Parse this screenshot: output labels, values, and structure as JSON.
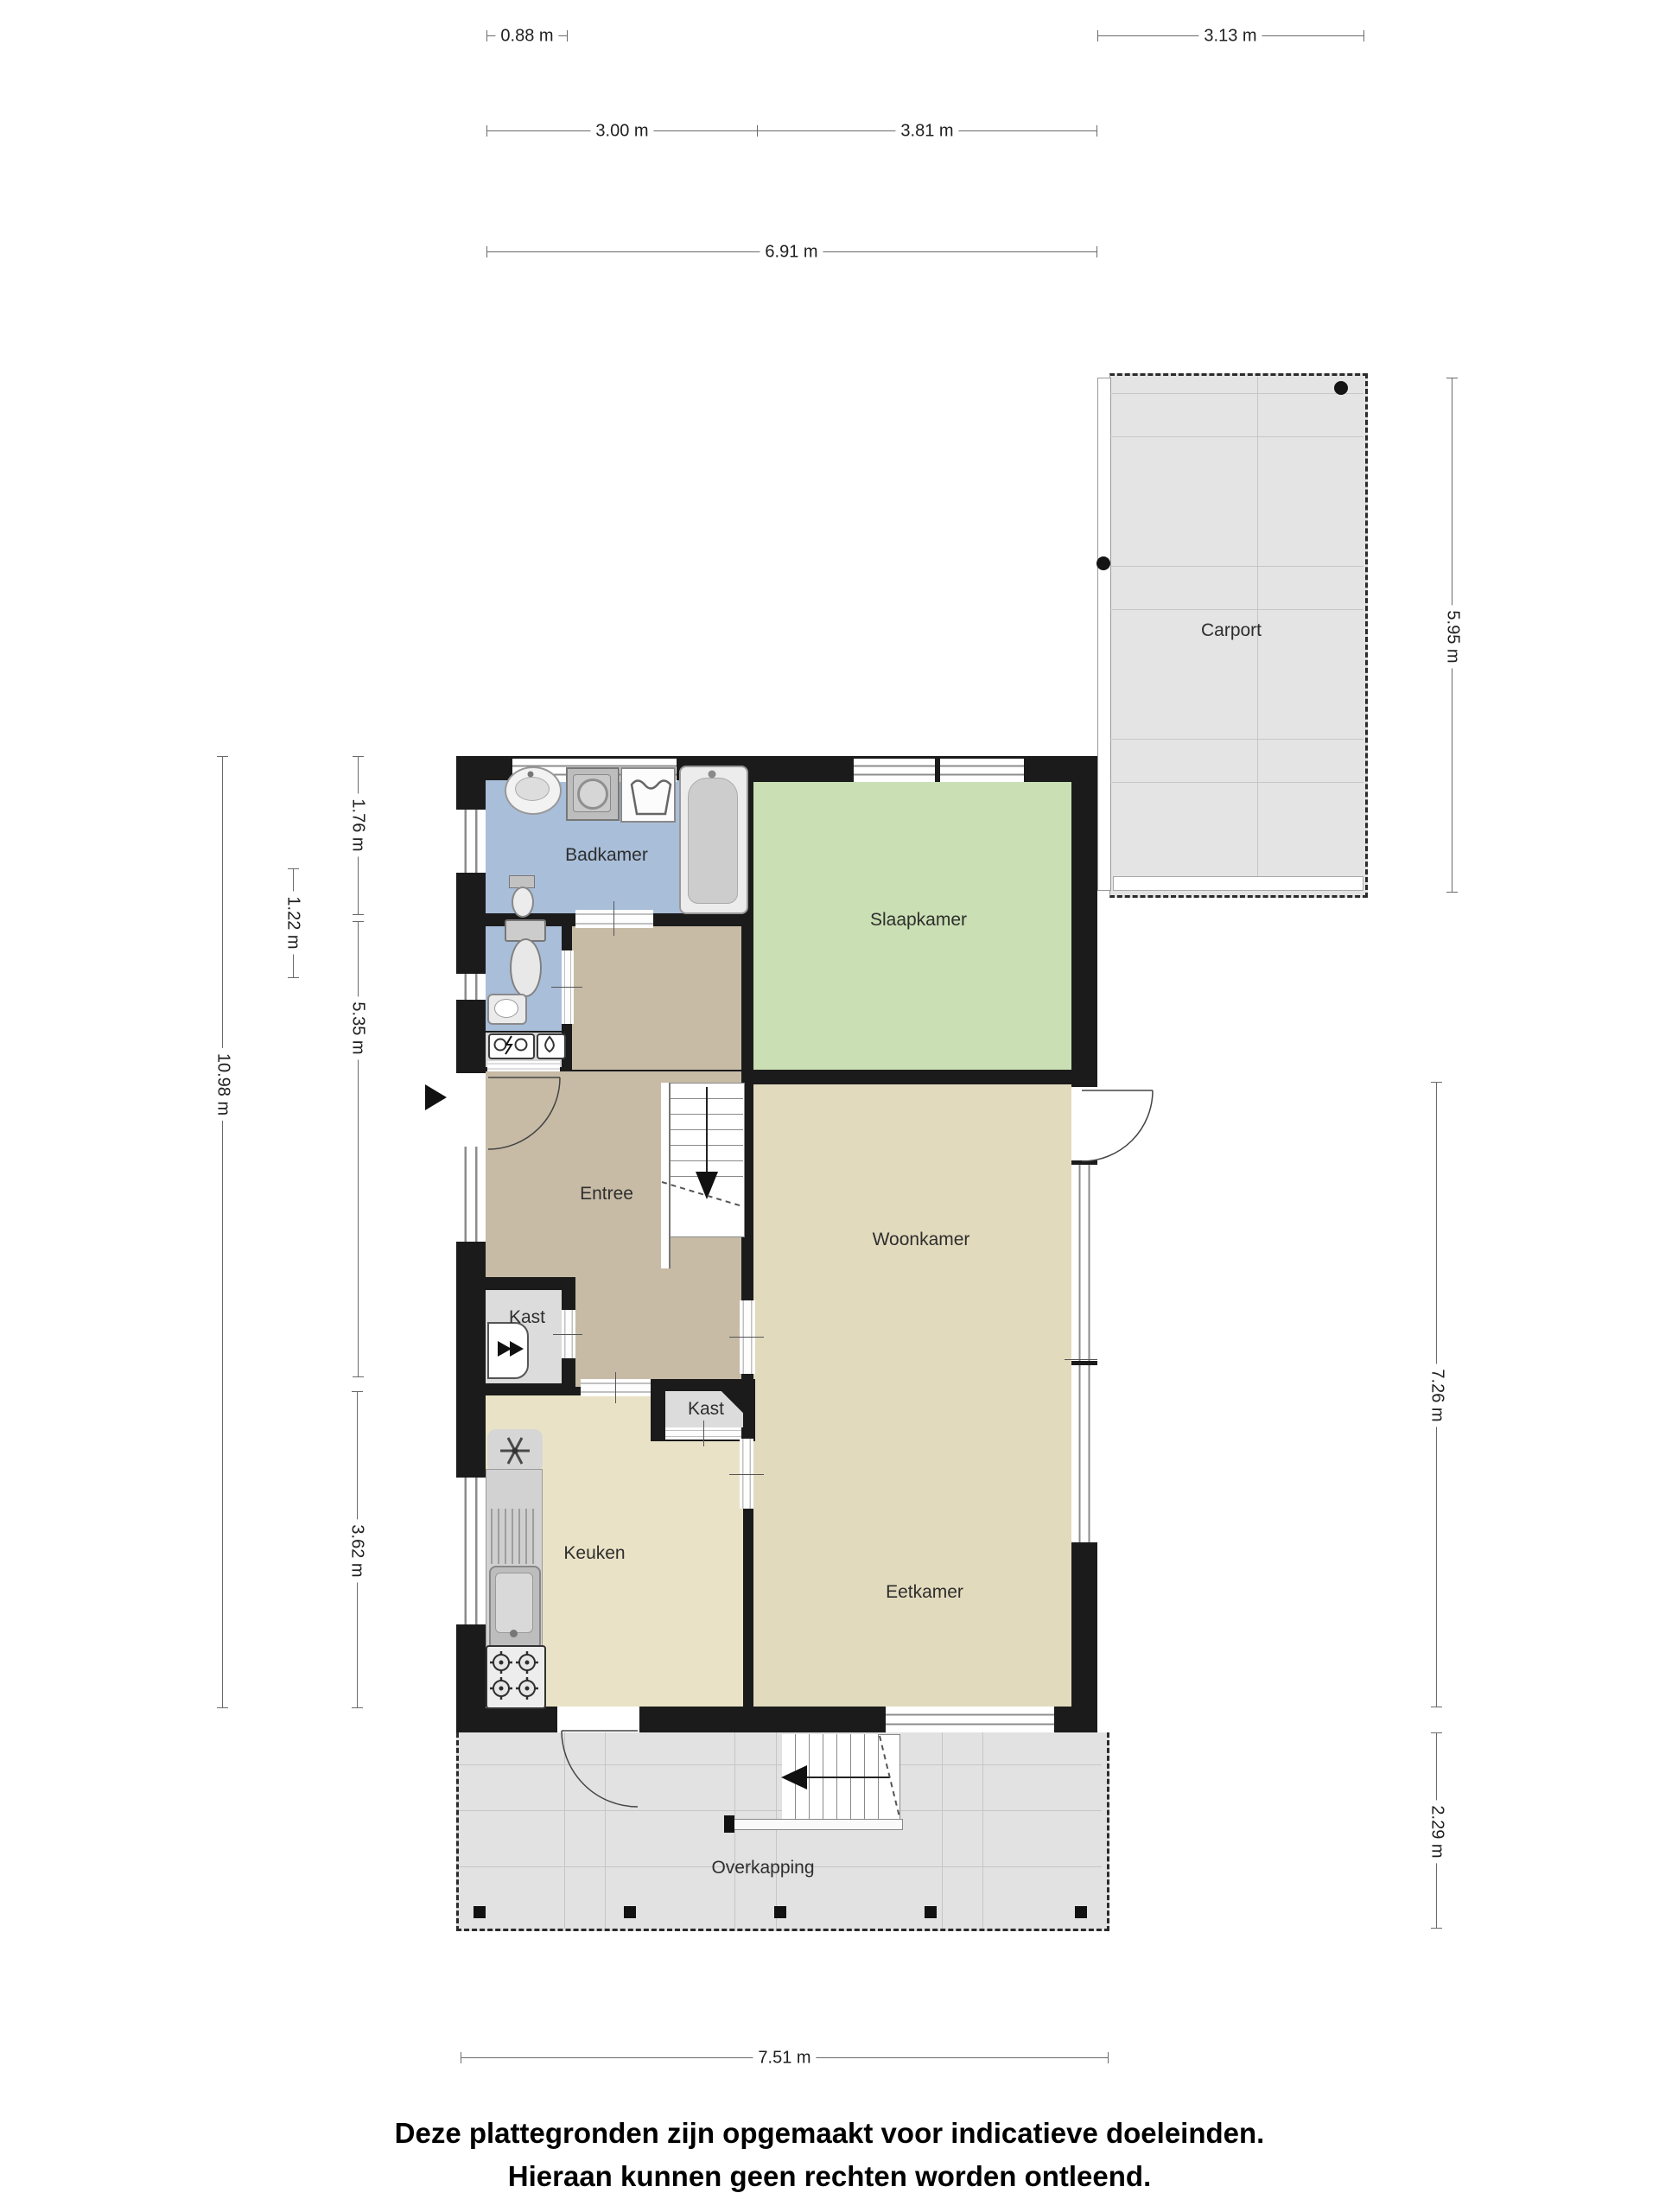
{
  "rooms": {
    "badkamer": "Badkamer",
    "slaapkamer": "Slaapkamer",
    "entree": "Entree",
    "woonkamer": "Woonkamer",
    "kast1": "Kast",
    "kast2": "Kast",
    "keuken": "Keuken",
    "eetkamer": "Eetkamer",
    "overkapping": "Overkapping",
    "carport": "Carport"
  },
  "dimensions": {
    "top_left_small": "0.88 m",
    "top_right_small": "3.13 m",
    "top_row2_left": "3.00 m",
    "top_row2_right": "3.81 m",
    "top_total": "6.91 m",
    "left_total": "10.98 m",
    "left_badkamer": "1.76 m",
    "left_wc": "1.22 m",
    "left_entree": "5.35 m",
    "left_keuken": "3.62 m",
    "right_carport": "5.95 m",
    "right_woonkamer": "7.26 m",
    "right_overkapping": "2.29 m",
    "bottom_total": "7.51 m"
  },
  "disclaimer": {
    "line1": "Deze plattegronden zijn opgemaakt voor indicatieve doeleinden.",
    "line2": "Hieraan kunnen geen rechten worden ontleend."
  },
  "colors": {
    "wall": "#1b1b1b",
    "badkamer_floor": "#a9bed9",
    "slaapkamer_floor": "#cadfb3",
    "entree_floor": "#c7bba6",
    "woonkamer_floor": "#e2dabd",
    "keuken_floor": "#eae2c6",
    "kast_floor": "#dcdcdc",
    "outdoor_floor": "#e4e4e4"
  }
}
